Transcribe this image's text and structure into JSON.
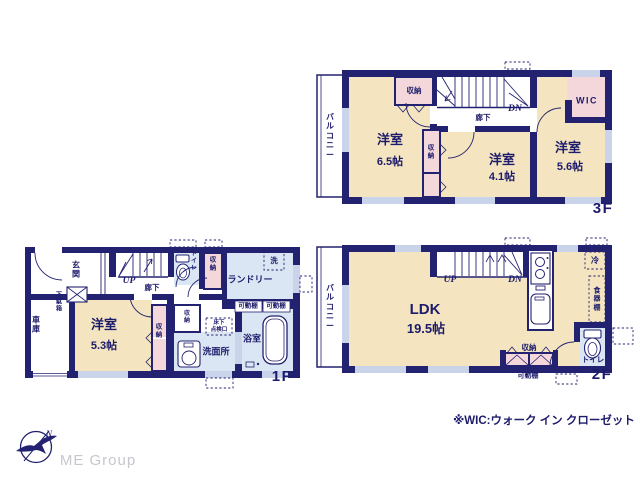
{
  "colors": {
    "wall": "#232270",
    "room_cream": "#f4e5c0",
    "closet_pink": "#f4d7da",
    "wet_blue": "#dae6f3",
    "window_slot": "#c9d3ea",
    "text_navy": "#1d1b6b",
    "logo_gray": "#c6c6ce",
    "white": "#ffffff"
  },
  "floors": {
    "f3": {
      "label": "3F",
      "balcony": "バルコニー",
      "closet_top": "収納",
      "closet_mid": "収納",
      "dn": "DN",
      "hallway": "廊下",
      "room1": "洋室",
      "room1_size": "6.5帖",
      "room2": "洋室",
      "room2_size": "4.1帖",
      "room3": "洋室",
      "room3_size": "5.6帖",
      "wic": "WIC"
    },
    "f2": {
      "label": "2F",
      "balcony": "バルコニー",
      "up": "UP",
      "dn": "DN",
      "ldk": "LDK",
      "ldk_size": "19.5帖",
      "fridge": "冷",
      "cupboard": "食器棚",
      "closet": "収納",
      "shelf": "可動棚",
      "toilet": "トイレ"
    },
    "f1": {
      "label": "1F",
      "entrance": "玄関",
      "shoe_box": "下駄箱",
      "garage": "車庫",
      "up": "UP",
      "hallway": "廊下",
      "toilet": "トイレ",
      "closet_top": "収納",
      "laundry": "ランドリー",
      "washer": "洗",
      "shelf_left": "可動棚",
      "shelf_right": "可動棚",
      "room": "洋室",
      "room_size": "5.3帖",
      "closet_mid": "収納",
      "closet_small": "収納",
      "hatch_line1": "床下",
      "hatch_line2": "点検口",
      "washroom": "洗面所",
      "bath": "浴室"
    }
  },
  "footer": {
    "note": "※WIC:ウォーク イン クローゼット",
    "logo_text": "ME Group",
    "compass_n": "N"
  }
}
